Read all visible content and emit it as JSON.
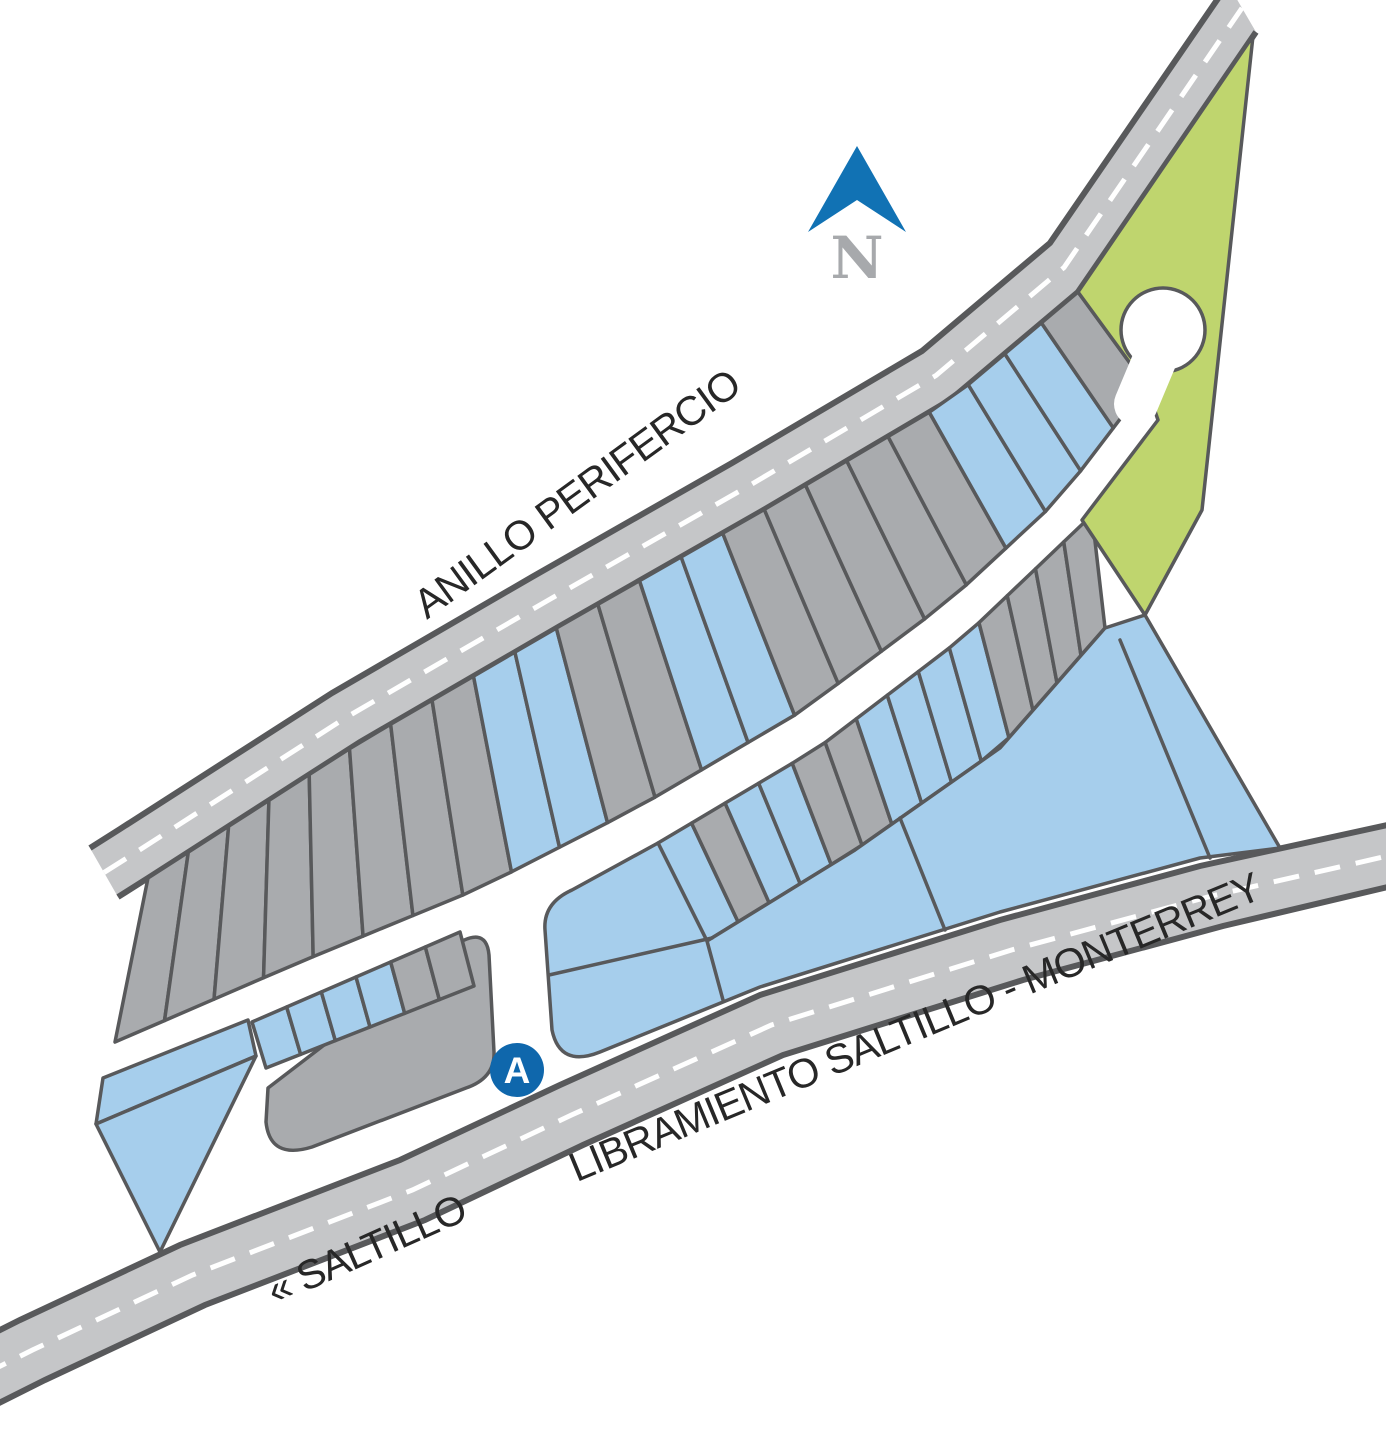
{
  "map": {
    "labels": {
      "anillo": "ANILLO PERIFERCIO",
      "libramiento": "LIBRAMIENTO SALTILLO - MONTERREY",
      "saltillo": "« SALTILLO"
    },
    "north_label": "N",
    "marker_label": "A",
    "palette": {
      "g": "#a9abae",
      "B": "#a6ceec",
      "G": "#bfd56e",
      "road": "#c5c6c8",
      "border": "#58595b",
      "white": "#ffffff",
      "marker_blue": "#0f67ac",
      "north_blue": "#1172b4",
      "north_gray": "#a7a9ac",
      "label_text": "#272727"
    },
    "geometry": {
      "roads": [
        {
          "name": "anillo-perifercio",
          "edge1": [
            [
              90,
              848
            ],
            [
              120,
              829
            ],
            [
              332,
              693
            ],
            [
              532,
              577
            ],
            [
              732,
              463
            ],
            [
              922,
              351
            ],
            [
              1050,
              243
            ],
            [
              1228,
              -16
            ]
          ],
          "edge2": [
            [
              118,
              897
            ],
            [
              148,
              878
            ],
            [
              360,
              742
            ],
            [
              560,
              626
            ],
            [
              760,
              512
            ],
            [
              950,
              400
            ],
            [
              1078,
              292
            ],
            [
              1256,
              32
            ]
          ]
        },
        {
          "name": "libramiento-saltillo-monterrey",
          "edge1": [
            [
              -30,
              1345
            ],
            [
              20,
              1320
            ],
            [
              180,
              1245
            ],
            [
              400,
              1160
            ],
            [
              560,
              1085
            ],
            [
              760,
              995
            ],
            [
              1000,
              920
            ],
            [
              1200,
              866
            ],
            [
              1392,
              824
            ]
          ],
          "edge2": [
            [
              -5,
              1405
            ],
            [
              45,
              1380
            ],
            [
              205,
              1305
            ],
            [
              425,
              1220
            ],
            [
              583,
              1145
            ],
            [
              783,
              1055
            ],
            [
              1023,
              980
            ],
            [
              1223,
              926
            ],
            [
              1392,
              886
            ]
          ]
        }
      ],
      "bands": [
        {
          "name": "north-lot-strip",
          "top": [
            [
              148,
              878
            ],
            [
              360,
              742
            ],
            [
              560,
              626
            ],
            [
              760,
              512
            ],
            [
              950,
              400
            ],
            [
              1078,
              292
            ]
          ],
          "bottom": [
            [
              115,
              1042
            ],
            [
              300,
              962
            ],
            [
              480,
              888
            ],
            [
              640,
              806
            ],
            [
              800,
              712
            ],
            [
              950,
              600
            ],
            [
              1060,
              498
            ],
            [
              1146,
              385
            ]
          ],
          "colors": [
            "g",
            "g",
            "g",
            "g",
            "g",
            "g",
            "g",
            "g",
            "B",
            "B",
            "g",
            "g",
            "B",
            "B",
            "g",
            "g",
            "g",
            "g",
            "g",
            "B",
            "B",
            "B",
            "g"
          ]
        },
        {
          "name": "south-lot-strip",
          "top": [
            [
              658,
              843
            ],
            [
              818,
              748
            ],
            [
              965,
              636
            ],
            [
              1092,
              515
            ]
          ],
          "bottom": [
            [
              707,
              941
            ],
            [
              855,
              850
            ],
            [
              1000,
              748
            ],
            [
              1105,
              628
            ]
          ],
          "colors": [
            "B",
            "g",
            "B",
            "B",
            "g",
            "g",
            "B",
            "B",
            "B",
            "B",
            "g",
            "g",
            "g",
            "g"
          ]
        },
        {
          "name": "west-lot-row",
          "top": [
            [
              252,
              1022
            ],
            [
              460,
              932
            ]
          ],
          "bottom": [
            [
              266,
              1068
            ],
            [
              474,
              986
            ]
          ],
          "colors": [
            "B",
            "B",
            "B",
            "B",
            "g",
            "g"
          ]
        }
      ],
      "parcels": [
        {
          "name": "southwest-gray-parcel",
          "fill": "g",
          "path": "M 268,1088 L 448,950 Q 486,922 489,955 L 494,1052 Q 495,1078 466,1088 L 312,1147 Q 270,1160 266,1122 Z"
        },
        {
          "name": "west-wedge-upper",
          "fill": "B",
          "points": [
            [
              103,
              1078
            ],
            [
              248,
              1020
            ],
            [
              256,
              1056
            ],
            [
              96,
              1124
            ]
          ]
        },
        {
          "name": "west-wedge-lower",
          "fill": "B",
          "points": [
            [
              96,
              1124
            ],
            [
              256,
              1056
            ],
            [
              160,
              1252
            ]
          ]
        },
        {
          "name": "big-blue-parcel",
          "fill": "B",
          "path": "M 658,843 L 707,941 L 855,850 L 1000,748 L 1105,628 L 1145,615 L 1280,848 L 1200,858 L 1000,912 L 760,987 L 600,1052 Q 560,1068 552,1030 L 545,930 Q 543,903 572,890 Z"
        },
        {
          "name": "green-reserve",
          "fill": "G",
          "points": [
            [
              1078,
              292
            ],
            [
              1253,
              36
            ],
            [
              1202,
              510
            ],
            [
              1145,
              615
            ],
            [
              1082,
              520
            ],
            [
              1158,
              420
            ],
            [
              1146,
              385
            ]
          ]
        }
      ],
      "dividers": [
        [
          [
            549,
            975
          ],
          [
            712,
            938
          ]
        ],
        [
          [
            707,
            941
          ],
          [
            723,
            1000
          ]
        ],
        [
          [
            900,
            818
          ],
          [
            945,
            930
          ]
        ],
        [
          [
            1120,
            640
          ],
          [
            1210,
            858
          ]
        ]
      ],
      "culdesac": {
        "cx": 1163,
        "cy": 330,
        "r": 42
      },
      "neck": [
        [
          1136,
          404
        ],
        [
          1162,
          342
        ]
      ],
      "marker": {
        "cx": 517,
        "cy": 1070,
        "r": 27
      }
    }
  }
}
